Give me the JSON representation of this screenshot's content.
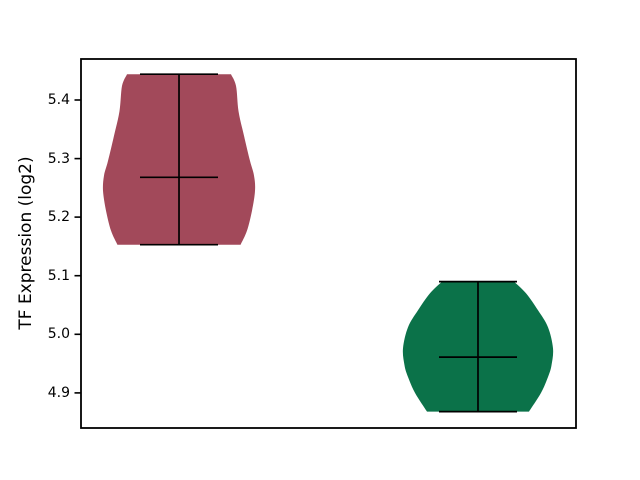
{
  "chart_data": {
    "type": "violin",
    "title": "",
    "xlabel": "",
    "ylabel": "TF Expression (log2)",
    "ylim": [
      4.84,
      5.47
    ],
    "grid": false,
    "legend": "none",
    "x_tick_labels": [],
    "y_ticks": [
      {
        "value": 5.4,
        "label": "5.4"
      },
      {
        "value": 5.3,
        "label": "5.3"
      },
      {
        "value": 5.2,
        "label": "5.2"
      },
      {
        "value": 5.1,
        "label": "5.1"
      },
      {
        "value": 5.0,
        "label": "5.0"
      },
      {
        "value": 4.9,
        "label": "4.9"
      }
    ],
    "series": [
      {
        "name": "group-1",
        "color": "#a2495a",
        "max": 5.444,
        "min": 5.153,
        "median": 5.268,
        "center_frac": 0.198,
        "profile": [
          [
            5.444,
            0.684
          ],
          [
            5.424,
            0.75
          ],
          [
            5.381,
            0.783
          ],
          [
            5.339,
            0.855
          ],
          [
            5.296,
            0.934
          ],
          [
            5.271,
            0.987
          ],
          [
            5.245,
            1.0
          ],
          [
            5.211,
            0.96
          ],
          [
            5.177,
            0.895
          ],
          [
            5.153,
            0.81
          ]
        ]
      },
      {
        "name": "group-2",
        "color": "#0b7249",
        "max": 5.09,
        "min": 4.868,
        "median": 4.961,
        "center_frac": 0.802,
        "profile": [
          [
            5.09,
            0.48
          ],
          [
            5.07,
            0.64
          ],
          [
            5.041,
            0.8
          ],
          [
            5.012,
            0.933
          ],
          [
            4.976,
            1.0
          ],
          [
            4.947,
            0.98
          ],
          [
            4.927,
            0.933
          ],
          [
            4.9,
            0.84
          ],
          [
            4.868,
            0.68
          ]
        ]
      }
    ],
    "colors": {
      "violin_1": "#a2495a",
      "violin_2": "#0b7249",
      "lines": "#000000",
      "frame": "#000000",
      "background": "#ffffff"
    }
  }
}
